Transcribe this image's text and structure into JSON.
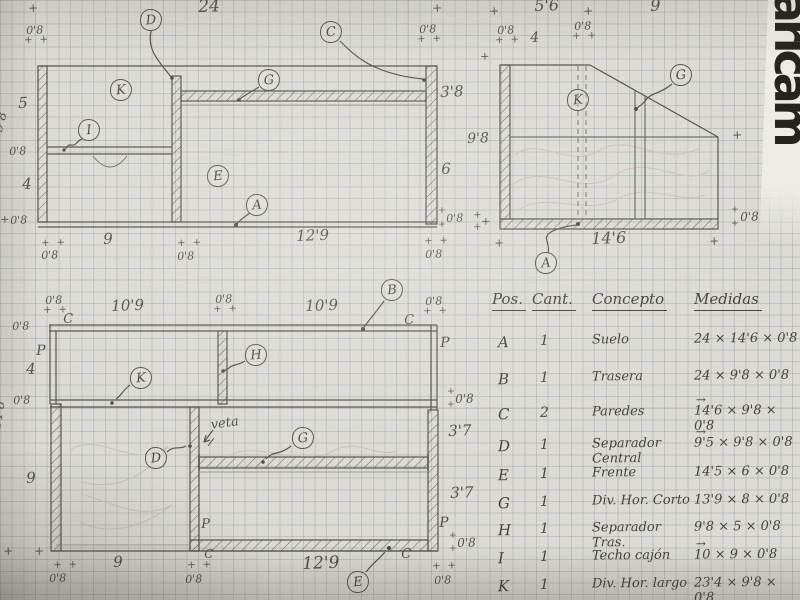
{
  "watermark": {
    "text": "aricam"
  },
  "table": {
    "headers": [
      "Pos.",
      "Cant.",
      "Concepto",
      "Medidas"
    ],
    "rows": [
      {
        "pos": "A",
        "cant": "1",
        "concepto": "Suelo",
        "medidas": "24 × 14'6 × 0'8",
        "vec": false
      },
      {
        "pos": "B",
        "cant": "1",
        "concepto": "Trasera",
        "medidas": "24 × 9'8 × 0'8",
        "vec": false
      },
      {
        "pos": "C",
        "cant": "2",
        "concepto": "Paredes",
        "medidas": "14'6 × 9'8 × 0'8",
        "vec": true
      },
      {
        "pos": "D",
        "cant": "1",
        "concepto": "Separador Central",
        "medidas": "9'5 × 9'8 × 0'8",
        "vec": true
      },
      {
        "pos": "E",
        "cant": "1",
        "concepto": "Frente",
        "medidas": "14'5 × 6 × 0'8",
        "vec": false
      },
      {
        "pos": "G",
        "cant": "1",
        "concepto": "Div. Hor. Corto",
        "medidas": "13'9 × 8 × 0'8",
        "vec": false
      },
      {
        "pos": "H",
        "cant": "1",
        "concepto": "Separador Tras.",
        "medidas": "9'8 × 5 × 0'8",
        "vec": false
      },
      {
        "pos": "I",
        "cant": "1",
        "concepto": "Techo cajón",
        "medidas": "10 × 9 × 0'8",
        "vec": true
      },
      {
        "pos": "K",
        "cant": "1",
        "concepto": "Div. Hor. largo",
        "medidas": "23'4 × 9'8 × 0'8",
        "vec": false
      }
    ]
  },
  "callouts": [
    {
      "letter": "D",
      "x": 151,
      "y": 20
    },
    {
      "letter": "C",
      "x": 331,
      "y": 32
    },
    {
      "letter": "K",
      "x": 121,
      "y": 90
    },
    {
      "letter": "G",
      "x": 269,
      "y": 80
    },
    {
      "letter": "I",
      "x": 89,
      "y": 130
    },
    {
      "letter": "E",
      "x": 218,
      "y": 176
    },
    {
      "letter": "A",
      "x": 257,
      "y": 205
    },
    {
      "letter": "K",
      "x": 578,
      "y": 100
    },
    {
      "letter": "G",
      "x": 681,
      "y": 75
    },
    {
      "letter": "A",
      "x": 546,
      "y": 263
    },
    {
      "letter": "B",
      "x": 392,
      "y": 290
    },
    {
      "letter": "H",
      "x": 256,
      "y": 355
    },
    {
      "letter": "K",
      "x": 141,
      "y": 378
    },
    {
      "letter": "D",
      "x": 156,
      "y": 458
    },
    {
      "letter": "G",
      "x": 303,
      "y": 438
    },
    {
      "letter": "E",
      "x": 358,
      "y": 582
    }
  ],
  "labels": [
    {
      "name": "tick",
      "text": "+",
      "x": 28,
      "y": 2,
      "size": 12,
      "cls": "plus"
    },
    {
      "name": "dim-0-8",
      "text": "0'8",
      "x": 26,
      "y": 25,
      "size": 11
    },
    {
      "name": "tick",
      "text": "+ +",
      "x": 24,
      "y": 36,
      "size": 10,
      "cls": "plus"
    },
    {
      "name": "dim-24",
      "text": "24",
      "x": 198,
      "y": -1,
      "size": 17
    },
    {
      "name": "tick",
      "text": "+",
      "x": 432,
      "y": 2,
      "size": 12,
      "cls": "plus"
    },
    {
      "name": "dim-0-8",
      "text": "0'8",
      "x": 419,
      "y": 24,
      "size": 11
    },
    {
      "name": "tick",
      "text": "+ +",
      "x": 417,
      "y": 35,
      "size": 10,
      "cls": "plus"
    },
    {
      "name": "dim-5",
      "text": "5",
      "x": 18,
      "y": 96,
      "size": 15
    },
    {
      "name": "dim-3-8",
      "text": "3'8",
      "x": 440,
      "y": 85,
      "size": 15
    },
    {
      "name": "dim-9-8-rot",
      "text": "9'8",
      "x": -8,
      "y": 130,
      "size": 13,
      "rot": -75
    },
    {
      "name": "dim-0-8",
      "text": "0'8",
      "x": 9,
      "y": 146,
      "size": 11
    },
    {
      "name": "dim-4",
      "text": "4",
      "x": 22,
      "y": 177,
      "size": 15
    },
    {
      "name": "dim-6",
      "text": "6",
      "x": 441,
      "y": 162,
      "size": 15
    },
    {
      "name": "dim-9-8",
      "text": "9'8",
      "x": 467,
      "y": 132,
      "size": 14
    },
    {
      "name": "tick",
      "text": "+",
      "x": 0,
      "y": 214,
      "size": 11,
      "cls": "plus"
    },
    {
      "name": "dim-0-8",
      "text": "0'8",
      "x": 10,
      "y": 215,
      "size": 11
    },
    {
      "name": "tick",
      "text": "+",
      "x": 480,
      "y": 51,
      "size": 11,
      "cls": "plus"
    },
    {
      "name": "tick",
      "text": "+",
      "x": 438,
      "y": 207,
      "size": 9,
      "cls": "plus"
    },
    {
      "name": "dim-0-8",
      "text": "0'8",
      "x": 446,
      "y": 213,
      "size": 11
    },
    {
      "name": "tick",
      "text": "+",
      "x": 438,
      "y": 221,
      "size": 9,
      "cls": "plus"
    },
    {
      "name": "tick",
      "text": "+",
      "x": 481,
      "y": 216,
      "size": 11,
      "cls": "plus"
    },
    {
      "name": "tick",
      "text": "+ +",
      "x": 41,
      "y": 239,
      "size": 10,
      "cls": "plus"
    },
    {
      "name": "dim-0-8",
      "text": "0'8",
      "x": 41,
      "y": 250,
      "size": 11
    },
    {
      "name": "dim-9",
      "text": "9",
      "x": 103,
      "y": 232,
      "size": 15
    },
    {
      "name": "tick",
      "text": "+ +",
      "x": 177,
      "y": 239,
      "size": 10,
      "cls": "plus"
    },
    {
      "name": "dim-0-8",
      "text": "0'8",
      "x": 177,
      "y": 251,
      "size": 11
    },
    {
      "name": "dim-12-9",
      "text": "12'9",
      "x": 296,
      "y": 229,
      "size": 15
    },
    {
      "name": "tick",
      "text": "+ +",
      "x": 424,
      "y": 237,
      "size": 10,
      "cls": "plus"
    },
    {
      "name": "dim-0-8",
      "text": "0'8",
      "x": 425,
      "y": 249,
      "size": 11
    },
    {
      "name": "tick",
      "text": "+",
      "x": 489,
      "y": 5,
      "size": 12,
      "cls": "plus"
    },
    {
      "name": "dim-5-6",
      "text": "5'6",
      "x": 534,
      "y": -2,
      "size": 16
    },
    {
      "name": "tick",
      "text": "+",
      "x": 583,
      "y": 5,
      "size": 12,
      "cls": "plus"
    },
    {
      "name": "dim-9-top",
      "text": "9",
      "x": 650,
      "y": -2,
      "size": 16
    },
    {
      "name": "tick",
      "text": "+",
      "x": 779,
      "y": 5,
      "size": 12,
      "cls": "plus"
    },
    {
      "name": "dim-0-8",
      "text": "0'8",
      "x": 497,
      "y": 25,
      "size": 11
    },
    {
      "name": "tick",
      "text": "+ +",
      "x": 495,
      "y": 36,
      "size": 10,
      "cls": "plus"
    },
    {
      "name": "dim-4b",
      "text": "4",
      "x": 530,
      "y": 31,
      "size": 14
    },
    {
      "name": "dim-0-8",
      "text": "0'8",
      "x": 574,
      "y": 21,
      "size": 11
    },
    {
      "name": "tick",
      "text": "+ +",
      "x": 572,
      "y": 32,
      "size": 10,
      "cls": "plus"
    },
    {
      "name": "tick",
      "text": "+",
      "x": 732,
      "y": 129,
      "size": 12,
      "cls": "plus"
    },
    {
      "name": "tick",
      "text": "+",
      "x": 473,
      "y": 211,
      "size": 10,
      "cls": "plus"
    },
    {
      "name": "tick",
      "text": "+",
      "x": 473,
      "y": 223,
      "size": 10,
      "cls": "plus"
    },
    {
      "name": "tick",
      "text": "+",
      "x": 731,
      "y": 206,
      "size": 9,
      "cls": "plus"
    },
    {
      "name": "dim-0-8",
      "text": "0'8",
      "x": 740,
      "y": 211,
      "size": 12
    },
    {
      "name": "tick",
      "text": "+",
      "x": 731,
      "y": 220,
      "size": 9,
      "cls": "plus"
    },
    {
      "name": "tick",
      "text": "+",
      "x": 494,
      "y": 237,
      "size": 12,
      "cls": "plus"
    },
    {
      "name": "dim-14-6",
      "text": "14'6",
      "x": 591,
      "y": 231,
      "size": 16
    },
    {
      "name": "tick",
      "text": "+",
      "x": 709,
      "y": 235,
      "size": 12,
      "cls": "plus"
    },
    {
      "name": "logo-dot",
      "text": "·",
      "x": 792,
      "y": 128,
      "size": 16,
      "cls": "plus"
    },
    {
      "name": "dim-0-8",
      "text": "0'8",
      "x": 45,
      "y": 295,
      "size": 11
    },
    {
      "name": "tick",
      "text": "+ +",
      "x": 43,
      "y": 306,
      "size": 10,
      "cls": "plus"
    },
    {
      "name": "letter-C",
      "text": "C",
      "x": 63,
      "y": 313,
      "size": 13
    },
    {
      "name": "dim-10-9",
      "text": "10'9",
      "x": 111,
      "y": 299,
      "size": 15
    },
    {
      "name": "dim-0-8",
      "text": "0'8",
      "x": 215,
      "y": 294,
      "size": 11
    },
    {
      "name": "tick",
      "text": "+ +",
      "x": 213,
      "y": 305,
      "size": 10,
      "cls": "plus"
    },
    {
      "name": "dim-10-9",
      "text": "10'9",
      "x": 305,
      "y": 299,
      "size": 15
    },
    {
      "name": "letter-C",
      "text": "C",
      "x": 404,
      "y": 314,
      "size": 13
    },
    {
      "name": "dim-0-8",
      "text": "0'8",
      "x": 425,
      "y": 296,
      "size": 11
    },
    {
      "name": "tick",
      "text": "+ +",
      "x": 423,
      "y": 307,
      "size": 10,
      "cls": "plus"
    },
    {
      "name": "dim-0-8",
      "text": "0'8",
      "x": 12,
      "y": 321,
      "size": 11
    },
    {
      "name": "letter-P",
      "text": "P",
      "x": 36,
      "y": 344,
      "size": 14
    },
    {
      "name": "dim-4c",
      "text": "4",
      "x": 26,
      "y": 362,
      "size": 15
    },
    {
      "name": "letter-P",
      "text": "P",
      "x": 440,
      "y": 336,
      "size": 14
    },
    {
      "name": "dim-0-8",
      "text": "0'8",
      "x": 13,
      "y": 395,
      "size": 11
    },
    {
      "name": "tick",
      "text": "+",
      "x": 447,
      "y": 388,
      "size": 9,
      "cls": "plus"
    },
    {
      "name": "dim-0-8",
      "text": "0'8",
      "x": 455,
      "y": 393,
      "size": 12
    },
    {
      "name": "tick",
      "text": "+",
      "x": 447,
      "y": 401,
      "size": 9,
      "cls": "plus"
    },
    {
      "name": "grain-note",
      "text": "veta",
      "x": 210,
      "y": 419,
      "size": 13,
      "rot": -8
    },
    {
      "name": "dim-3-7",
      "text": "3'7",
      "x": 448,
      "y": 424,
      "size": 15
    },
    {
      "name": "dim-14-6-rot",
      "text": "14'6",
      "x": -10,
      "y": 428,
      "size": 13,
      "rot": -80
    },
    {
      "name": "dim-9c",
      "text": "9",
      "x": 26,
      "y": 471,
      "size": 15
    },
    {
      "name": "dim-3-7",
      "text": "3'7",
      "x": 450,
      "y": 486,
      "size": 15
    },
    {
      "name": "letter-P",
      "text": "P",
      "x": 201,
      "y": 518,
      "size": 13
    },
    {
      "name": "letter-P",
      "text": "P",
      "x": 439,
      "y": 516,
      "size": 14
    },
    {
      "name": "tick",
      "text": "+",
      "x": 449,
      "y": 532,
      "size": 9,
      "cls": "plus"
    },
    {
      "name": "dim-0-8",
      "text": "0'8",
      "x": 457,
      "y": 537,
      "size": 12
    },
    {
      "name": "tick",
      "text": "+",
      "x": 449,
      "y": 545,
      "size": 9,
      "cls": "plus"
    },
    {
      "name": "tick",
      "text": "+",
      "x": 3,
      "y": 545,
      "size": 12,
      "cls": "plus"
    },
    {
      "name": "tick",
      "text": "+",
      "x": 34,
      "y": 545,
      "size": 12,
      "cls": "plus"
    },
    {
      "name": "tick",
      "text": "+ +",
      "x": 53,
      "y": 561,
      "size": 10,
      "cls": "plus"
    },
    {
      "name": "dim-0-8",
      "text": "0'8",
      "x": 49,
      "y": 573,
      "size": 11
    },
    {
      "name": "dim-9d",
      "text": "9",
      "x": 113,
      "y": 555,
      "size": 15
    },
    {
      "name": "tick",
      "text": "+ +",
      "x": 187,
      "y": 561,
      "size": 10,
      "cls": "plus"
    },
    {
      "name": "dim-0-8",
      "text": "0'8",
      "x": 185,
      "y": 574,
      "size": 11
    },
    {
      "name": "letter-C",
      "text": "C",
      "x": 204,
      "y": 548,
      "size": 12
    },
    {
      "name": "dim-12-9",
      "text": "12'9",
      "x": 302,
      "y": 556,
      "size": 17
    },
    {
      "name": "letter-C",
      "text": "C",
      "x": 401,
      "y": 548,
      "size": 13
    },
    {
      "name": "tick",
      "text": "+ +",
      "x": 432,
      "y": 562,
      "size": 10,
      "cls": "plus"
    },
    {
      "name": "dim-0-8",
      "text": "0'8",
      "x": 434,
      "y": 575,
      "size": 11
    }
  ]
}
